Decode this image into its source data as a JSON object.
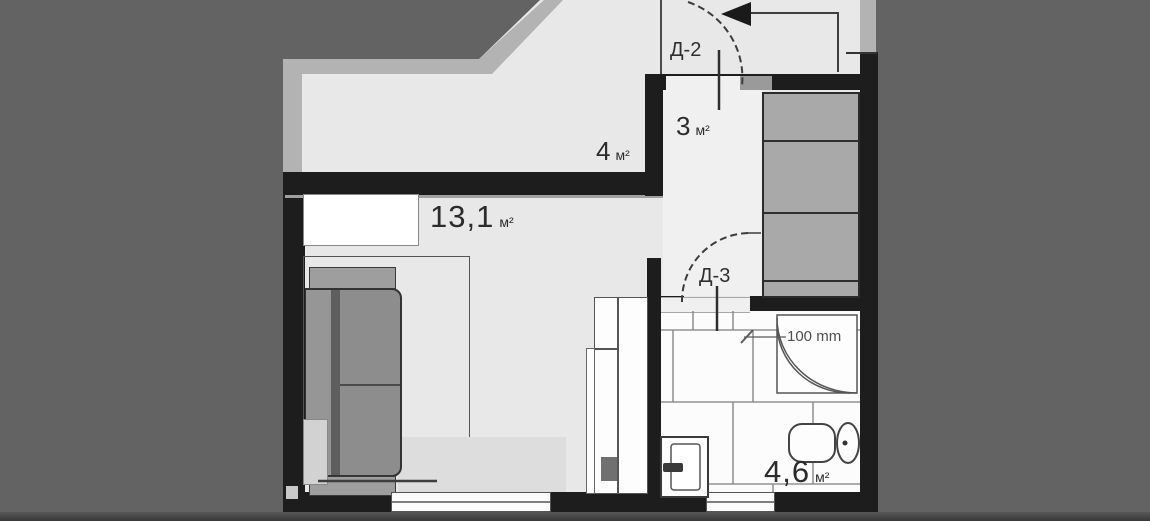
{
  "plan": {
    "rooms": [
      {
        "id": "corridor",
        "area": "4",
        "unit": "м²"
      },
      {
        "id": "entry-hall",
        "area": "3",
        "unit": "м²"
      },
      {
        "id": "living",
        "area": "13,1",
        "unit": "м²"
      },
      {
        "id": "bathroom",
        "area": "4,6",
        "unit": "м²"
      }
    ],
    "doors": [
      {
        "id": "door-2",
        "label": "Д-2"
      },
      {
        "id": "door-3",
        "label": "Д-3"
      }
    ],
    "annotations": {
      "shower_dimension": "100 mm"
    },
    "colors": {
      "background": "#636363",
      "floor": "#e8e8e8",
      "walls": "#1d1d1d",
      "outer_band": "#b3b3b3",
      "furniture_gray": "#8d8d8d",
      "bathroom_floor": "#fcfcfc"
    }
  }
}
